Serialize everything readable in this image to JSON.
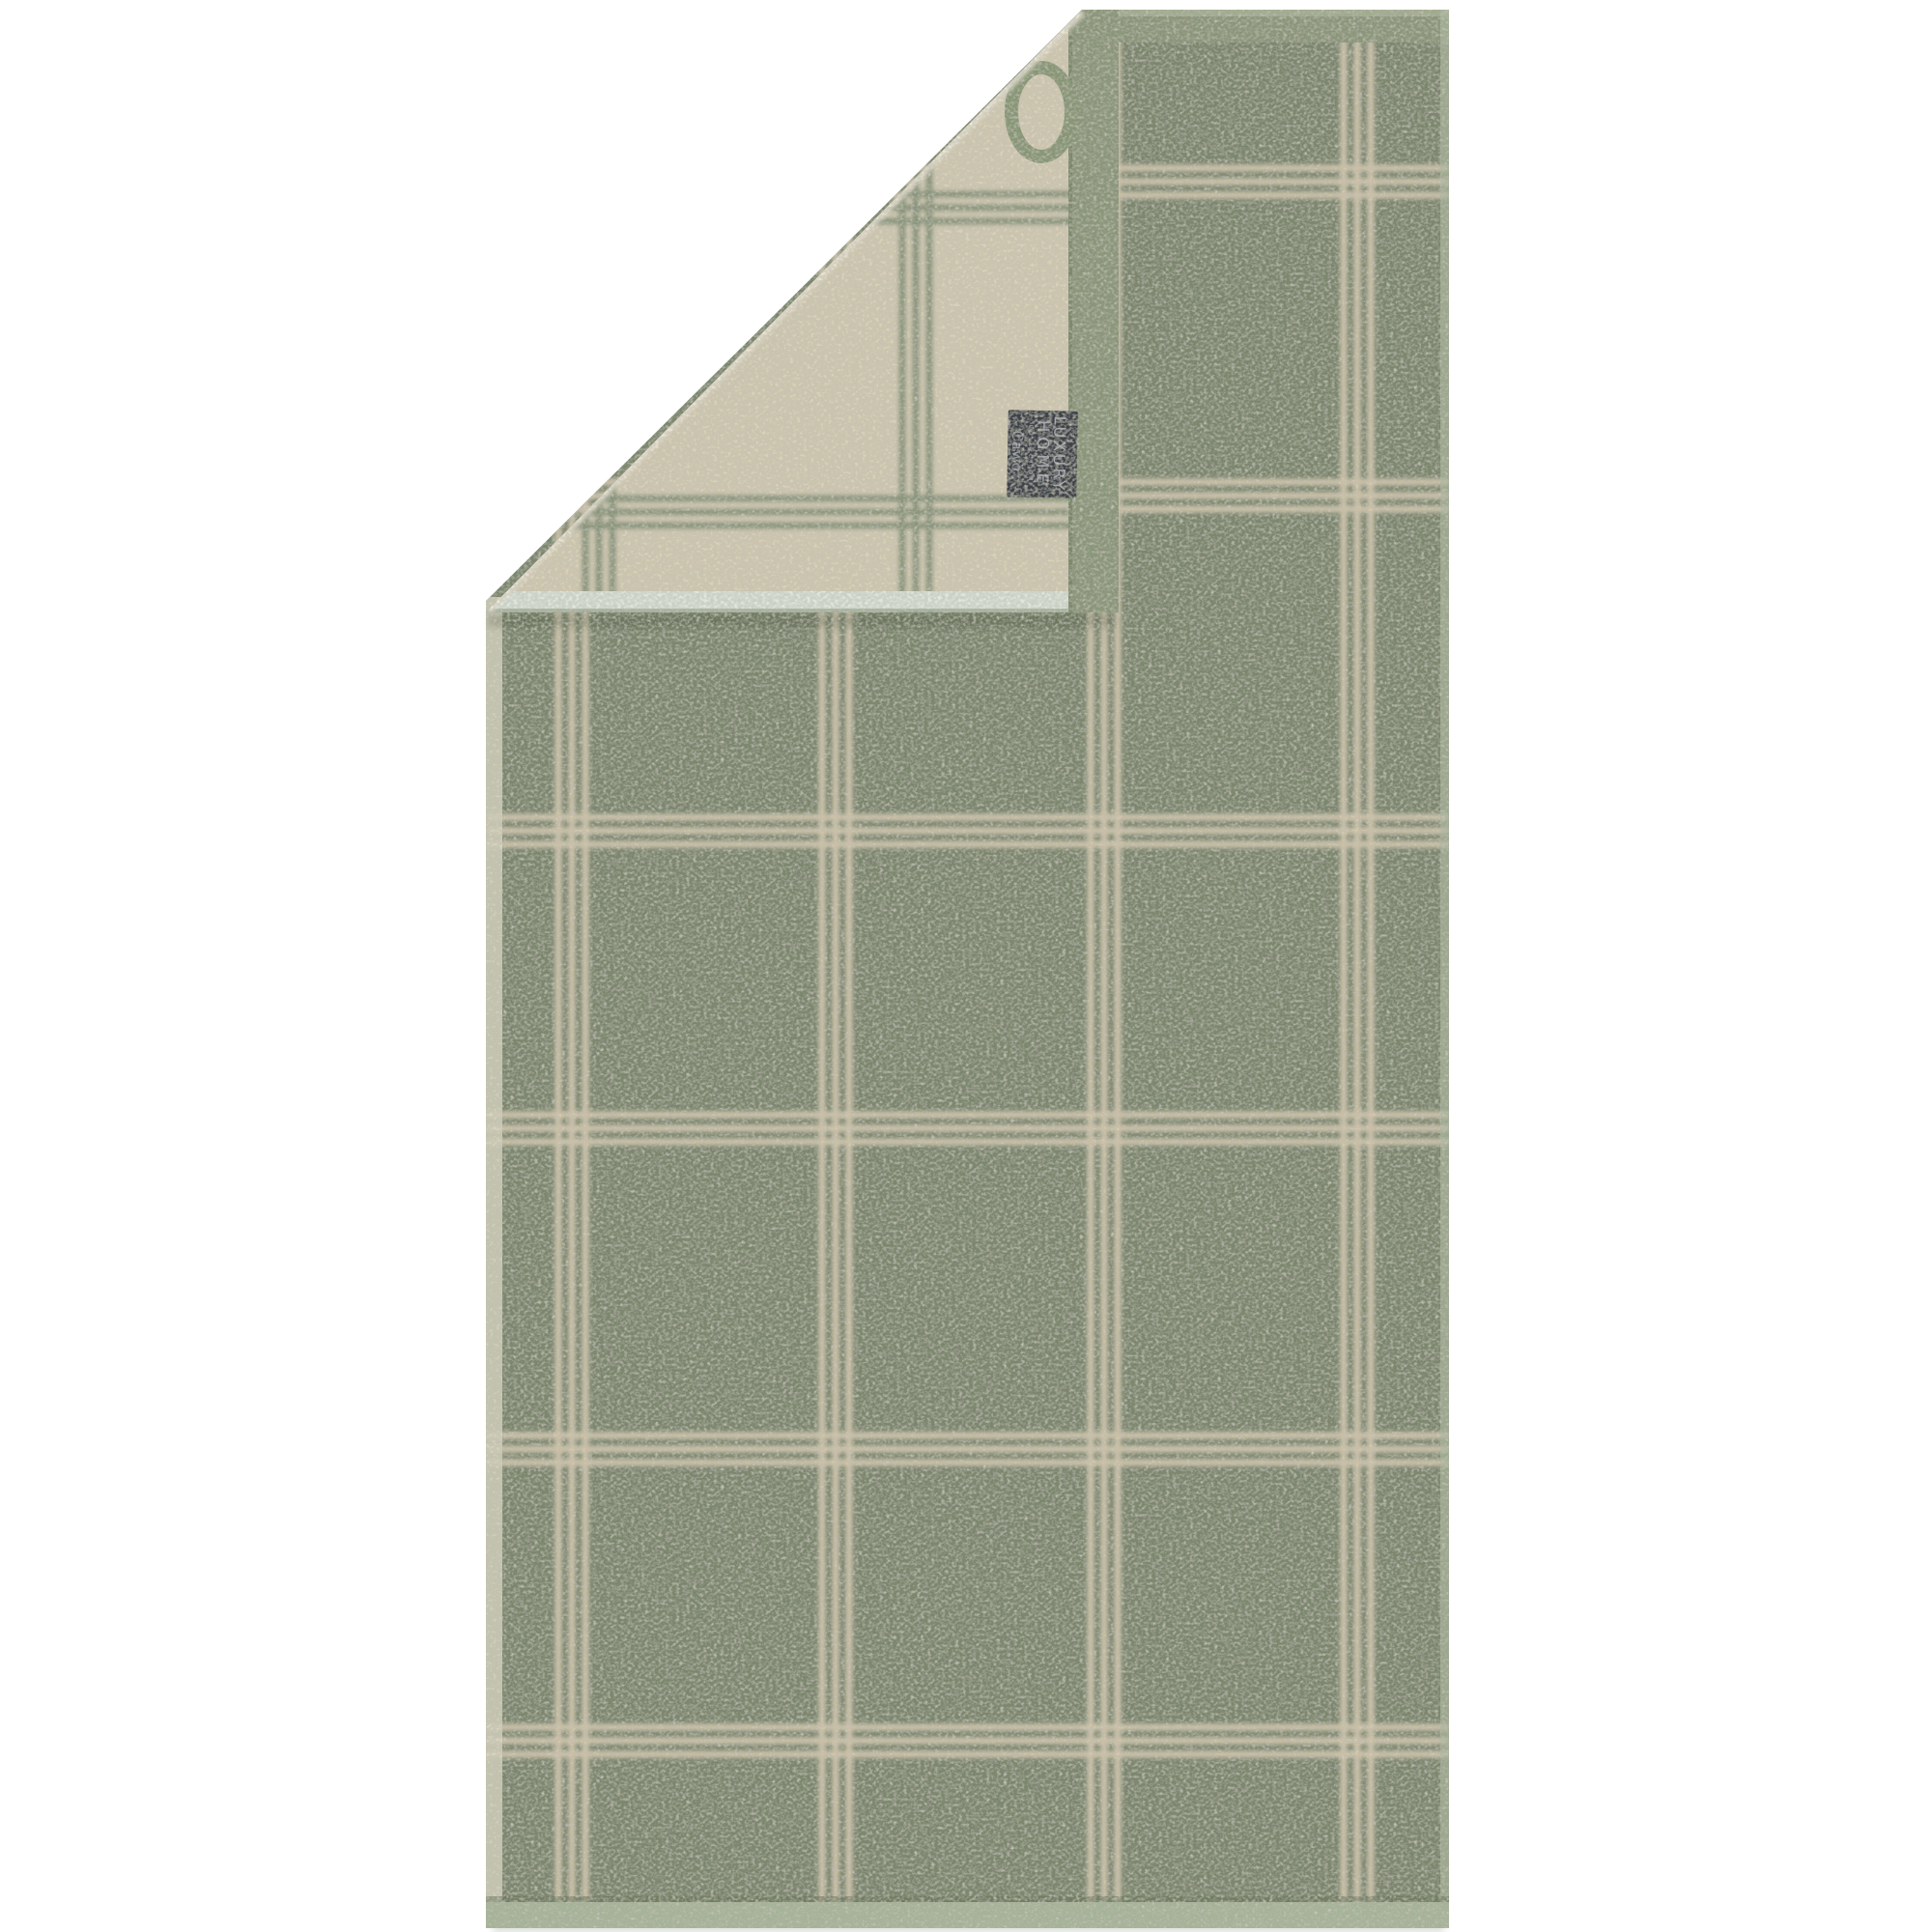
{
  "scene": {
    "background_color": "#ffffff"
  },
  "towel": {
    "front": {
      "base_color": "#7e8970",
      "line_color": "#d6cab0",
      "top_hem_color": "#8e9a7d",
      "top_hem_highlight": "#a8b296",
      "bottom_hem_color": "#abb99d",
      "bottom_hem_edge": "#69765a",
      "left_selvage_color": "#dcd9c4",
      "right_selvage_color": "#b2bfa4",
      "vertical_line_centers": [
        592,
        865,
        1143,
        1405
      ],
      "horizontal_line_centers": [
        188,
        513,
        860,
        1168,
        1500,
        1802
      ]
    },
    "flap": {
      "base_color": "#d9d0b8",
      "edge_fuzz_color": "#efe9da",
      "line_color": "#8c987e",
      "hem_band_color": "#8d9a7c",
      "hem_band_edge": "#768465",
      "selvage_band_color": "#dfe7dc",
      "selvage_band_edge": "#a3b29c",
      "fold_shadow_color": "#3d4a31",
      "ring_color": "#8a9a77",
      "vertical_line_centers": [
        620,
        948
      ],
      "horizontal_line_centers": [
        215,
        530
      ]
    },
    "tag": {
      "background": "#3c424b",
      "text_color": "#a9aeb6",
      "brand_color": "#9aa0a9",
      "lines": [
        "LUXURY",
        "HOME",
        "COLLECTION"
      ],
      "brand": "Cawö",
      "registered": "®"
    }
  }
}
